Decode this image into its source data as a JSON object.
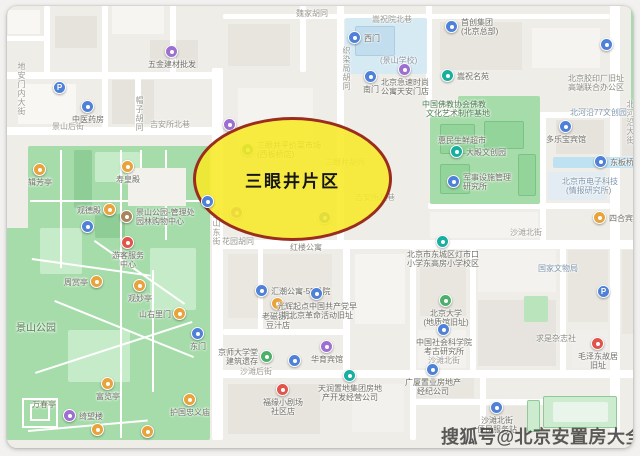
{
  "annotation": {
    "label": "三眼井片区"
  },
  "watermark": {
    "text": "搜狐号@北京安置房大全"
  },
  "colors": {
    "highlight_fill": "rgba(247,233,40,0.88)",
    "highlight_border": "#9b2d1f",
    "watermark": "#403f3d",
    "district": "#efede8",
    "road": "#ffffff",
    "park": "#a6dcaa",
    "water": "#bfe2f2"
  },
  "map": {
    "palette": {
      "blue": "#4f81d8",
      "purple": "#9d6fd0",
      "orange": "#e8a33c",
      "teal": "#17afa0",
      "green": "#4db06a",
      "red": "#e2544a",
      "brown": "#a8855c"
    },
    "blocks": [
      {
        "x": 8,
        "y": 10,
        "w": 32,
        "h": 24,
        "c": "#f8f7f4"
      },
      {
        "x": 55,
        "y": 16,
        "w": 42,
        "h": 32,
        "c": "#e6e3dd"
      },
      {
        "x": 112,
        "y": 6,
        "w": 52,
        "h": 28,
        "c": "#f6f5f2"
      },
      {
        "x": 150,
        "y": 40,
        "w": 48,
        "h": 28,
        "c": "#e6e3dd"
      },
      {
        "x": 18,
        "y": 84,
        "w": 58,
        "h": 40,
        "c": "#f8f7f4"
      },
      {
        "x": 112,
        "y": 80,
        "w": 42,
        "h": 44,
        "c": "#e6e3dd"
      },
      {
        "x": 228,
        "y": 24,
        "w": 62,
        "h": 42,
        "c": "#e8e5df"
      },
      {
        "x": 238,
        "y": 88,
        "w": 75,
        "h": 62,
        "c": "#f4f3ef"
      },
      {
        "x": 440,
        "y": 22,
        "w": 82,
        "h": 48,
        "c": "#e8e5df"
      },
      {
        "x": 532,
        "y": 28,
        "w": 68,
        "h": 40,
        "c": "#f5f4f1"
      },
      {
        "x": 556,
        "y": 120,
        "w": 48,
        "h": 34,
        "c": "#e6e3dd"
      },
      {
        "x": 548,
        "y": 172,
        "w": 58,
        "h": 28,
        "c": "#e3ecf2"
      },
      {
        "x": 430,
        "y": 212,
        "w": 108,
        "h": 26,
        "c": "#f4f3ef"
      },
      {
        "x": 228,
        "y": 254,
        "w": 104,
        "h": 64,
        "c": "#eae7e1"
      },
      {
        "x": 355,
        "y": 254,
        "w": 50,
        "h": 70,
        "c": "#f5f4f1"
      },
      {
        "x": 228,
        "y": 384,
        "w": 92,
        "h": 50,
        "c": "#e7e4de"
      },
      {
        "x": 352,
        "y": 384,
        "w": 52,
        "h": 48,
        "c": "#f2f1ee"
      },
      {
        "x": 420,
        "y": 254,
        "w": 46,
        "h": 62,
        "c": "#e9e6e0"
      },
      {
        "x": 478,
        "y": 250,
        "w": 78,
        "h": 42,
        "c": "#f3f2ef"
      },
      {
        "x": 568,
        "y": 250,
        "w": 40,
        "h": 72,
        "c": "#e9e6e0"
      },
      {
        "x": 478,
        "y": 300,
        "w": 78,
        "h": 66,
        "c": "#e7e4df"
      },
      {
        "x": 418,
        "y": 330,
        "w": 48,
        "h": 38,
        "c": "#f3f2ef"
      },
      {
        "x": 572,
        "y": 330,
        "w": 36,
        "h": 38,
        "c": "#f0efec"
      },
      {
        "x": 416,
        "y": 378,
        "w": 58,
        "h": 20,
        "c": "#e9e6e0"
      },
      {
        "x": 486,
        "y": 406,
        "w": 48,
        "h": 28,
        "c": "#e9e6e0"
      },
      {
        "x": 622,
        "y": 250,
        "w": 18,
        "h": 84,
        "c": "#e9e6e0"
      },
      {
        "x": 622,
        "y": 118,
        "w": 18,
        "h": 38,
        "c": "#e7e4df"
      }
    ],
    "roads": [
      {
        "x": 0,
        "y": 72,
        "w": 213,
        "h": 7
      },
      {
        "x": 0,
        "y": 127,
        "w": 213,
        "h": 8
      },
      {
        "x": 44,
        "y": 6,
        "w": 6,
        "h": 68
      },
      {
        "x": 102,
        "y": 0,
        "w": 6,
        "h": 129
      },
      {
        "x": 135,
        "y": 72,
        "w": 6,
        "h": 57
      },
      {
        "x": 170,
        "y": 0,
        "w": 6,
        "h": 74
      },
      {
        "x": 212,
        "y": 68,
        "w": 11,
        "h": 372
      },
      {
        "x": 212,
        "y": 240,
        "w": 428,
        "h": 9
      },
      {
        "x": 610,
        "y": 0,
        "w": 10,
        "h": 440
      },
      {
        "x": 300,
        "y": 0,
        "w": 6,
        "h": 72
      },
      {
        "x": 337,
        "y": 0,
        "w": 7,
        "h": 242
      },
      {
        "x": 426,
        "y": 0,
        "w": 6,
        "h": 114
      },
      {
        "x": 223,
        "y": 14,
        "w": 387,
        "h": 5
      },
      {
        "x": 428,
        "y": 112,
        "w": 182,
        "h": 6
      },
      {
        "x": 428,
        "y": 203,
        "w": 182,
        "h": 6
      },
      {
        "x": 540,
        "y": 112,
        "w": 6,
        "h": 130
      },
      {
        "x": 223,
        "y": 329,
        "w": 121,
        "h": 6
      },
      {
        "x": 212,
        "y": 370,
        "w": 428,
        "h": 8
      },
      {
        "x": 343,
        "y": 242,
        "w": 7,
        "h": 130
      },
      {
        "x": 410,
        "y": 242,
        "w": 6,
        "h": 198
      },
      {
        "x": 470,
        "y": 242,
        "w": 6,
        "h": 130
      },
      {
        "x": 560,
        "y": 242,
        "w": 6,
        "h": 130
      },
      {
        "x": 410,
        "y": 399,
        "w": 152,
        "h": 6
      },
      {
        "x": 480,
        "y": 372,
        "w": 6,
        "h": 68
      },
      {
        "x": 258,
        "y": 242,
        "w": 5,
        "h": 88
      },
      {
        "x": 0,
        "y": 36,
        "w": 45,
        "h": 5
      }
    ],
    "areas": [
      {
        "x": 28,
        "y": 146,
        "w": 182,
        "h": 294,
        "c": "#a6dcaa"
      },
      {
        "x": 0,
        "y": 228,
        "w": 30,
        "h": 212,
        "c": "#a6dcaa"
      },
      {
        "x": 95,
        "y": 152,
        "w": 45,
        "h": 30,
        "c": "#c6ebc8"
      },
      {
        "x": 40,
        "y": 228,
        "w": 42,
        "h": 46,
        "c": "#c6ebc8"
      },
      {
        "x": 150,
        "y": 248,
        "w": 46,
        "h": 62,
        "c": "#c6ebc8"
      },
      {
        "x": 68,
        "y": 330,
        "w": 62,
        "h": 52,
        "c": "#c6ebc8"
      },
      {
        "x": 74,
        "y": 150,
        "w": 18,
        "h": 58,
        "c": "#8fcd96"
      },
      {
        "x": 95,
        "y": 214,
        "w": 30,
        "h": 24,
        "c": "#8fcd96"
      },
      {
        "x": 430,
        "y": 116,
        "w": 110,
        "h": 88,
        "c": "#a6dcaa"
      },
      {
        "x": 458,
        "y": 96,
        "w": 82,
        "h": 22,
        "c": "#a6dcaa"
      },
      {
        "x": 440,
        "y": 124,
        "w": 35,
        "h": 30,
        "c": "#93d49a",
        "b": "#7cc287"
      },
      {
        "x": 484,
        "y": 121,
        "w": 40,
        "h": 28,
        "c": "#93d49a",
        "b": "#7cc287"
      },
      {
        "x": 440,
        "y": 164,
        "w": 30,
        "h": 30,
        "c": "#93d49a",
        "b": "#7cc287"
      },
      {
        "x": 518,
        "y": 154,
        "w": 18,
        "h": 42,
        "c": "#93d49a",
        "b": "#7cc287"
      },
      {
        "x": 631,
        "y": 0,
        "w": 9,
        "h": 112,
        "c": "#a6dcaa"
      },
      {
        "x": 524,
        "y": 296,
        "w": 24,
        "h": 26,
        "c": "#b9e4bc"
      },
      {
        "x": 527,
        "y": 400,
        "w": 13,
        "h": 32,
        "c": "#cdeccf",
        "b": "#8fc997"
      },
      {
        "x": 543,
        "y": 396,
        "w": 74,
        "h": 32,
        "c": "#cdeccf",
        "b": "#8fc997"
      },
      {
        "x": 553,
        "y": 402,
        "w": 55,
        "h": 20,
        "c": "#e9f5ea"
      },
      {
        "x": 345,
        "y": 18,
        "w": 82,
        "h": 56,
        "c": "#d6eaf4"
      },
      {
        "x": 355,
        "y": 26,
        "w": 40,
        "h": 30,
        "c": "#c2ddee",
        "b": "#aecde0"
      },
      {
        "x": 553,
        "y": 157,
        "w": 87,
        "h": 11,
        "c": "#bfe2f2"
      }
    ],
    "paths": [
      {
        "x": 30,
        "y": 200,
        "w": 172,
        "h": 2
      },
      {
        "x": 120,
        "y": 150,
        "w": 2,
        "h": 288
      },
      {
        "x": 60,
        "y": 150,
        "w": 2,
        "h": 118
      },
      {
        "x": 55,
        "y": 300,
        "w": 150,
        "h": 2,
        "rot": 22
      },
      {
        "x": 35,
        "y": 372,
        "w": 165,
        "h": 2,
        "rot": -18
      },
      {
        "x": 152,
        "y": 270,
        "w": 2,
        "h": 122
      },
      {
        "x": 32,
        "y": 258,
        "w": 120,
        "h": 2,
        "rot": 8
      },
      {
        "x": 165,
        "y": 150,
        "w": 2,
        "h": 90
      },
      {
        "x": 28,
        "y": 430,
        "w": 120,
        "h": 2,
        "rot": -5
      },
      {
        "x": 95,
        "y": 240,
        "w": 110,
        "h": 2,
        "rot": 35
      },
      {
        "x": 140,
        "y": 150,
        "w": 2,
        "h": 20
      },
      {
        "x": 128,
        "y": 168,
        "w": 58,
        "h": 38,
        "c": "#f2f1ec"
      },
      {
        "x": 22,
        "y": 398,
        "w": 36,
        "h": 30,
        "b": "#ffffff"
      },
      {
        "x": 30,
        "y": 404,
        "w": 20,
        "h": 17,
        "b": "#ffffff"
      }
    ],
    "labels": [
      {
        "x": 17,
        "y": 62,
        "t": "地安门内大街",
        "v": 1,
        "c": "#9a9992"
      },
      {
        "x": 52,
        "y": 122,
        "t": "景山后街",
        "c": "#9a9992"
      },
      {
        "x": 150,
        "y": 120,
        "t": "吉安所北巷",
        "c": "#9a9992"
      },
      {
        "x": 135,
        "y": 96,
        "t": "帽子胡同",
        "v": 1,
        "c": "#9a9992"
      },
      {
        "x": 212,
        "y": 210,
        "t": "景山东街",
        "v": 1,
        "c": "#9a9992"
      },
      {
        "x": 372,
        "y": 15,
        "t": "嵩祝院北巷",
        "c": "#9a9992"
      },
      {
        "x": 296,
        "y": 9,
        "t": "魏家胡同",
        "c": "#9a9992"
      },
      {
        "x": 342,
        "y": 46,
        "t": "织染局胡同",
        "v": 1,
        "c": "#9a9992"
      },
      {
        "x": 380,
        "y": 56,
        "t": "(景山学校)",
        "c": "#8d98a3"
      },
      {
        "x": 568,
        "y": 74,
        "t": "北京胶印厂旧址",
        "c": "#8a8a82"
      },
      {
        "x": 568,
        "y": 83,
        "t": "高端联合办公区",
        "c": "#8a8a82"
      },
      {
        "x": 570,
        "y": 108,
        "t": "北河沿77文创园",
        "c": "#7d96ad"
      },
      {
        "x": 626,
        "y": 100,
        "t": "北河沿大街",
        "v": 1,
        "c": "#9a9992"
      },
      {
        "x": 562,
        "y": 177,
        "t": "北京市电子科技",
        "c": "#7d96ad"
      },
      {
        "x": 566,
        "y": 186,
        "t": "(情报研究所)",
        "c": "#7d96ad"
      },
      {
        "x": 538,
        "y": 264,
        "t": "国家文物局",
        "c": "#7d96ad"
      },
      {
        "x": 536,
        "y": 334,
        "t": "求是杂志社",
        "c": "#8a8a82"
      },
      {
        "x": 510,
        "y": 228,
        "t": "沙滩北街",
        "c": "#9a9992"
      },
      {
        "x": 240,
        "y": 367,
        "t": "沙滩后街",
        "c": "#9a9992"
      },
      {
        "x": 428,
        "y": 356,
        "t": "沙滩北街",
        "c": "#9a9992"
      },
      {
        "x": 222,
        "y": 237,
        "t": "花园胡同",
        "c": "#9a9992",
        "u": 1
      },
      {
        "x": 290,
        "y": 243,
        "t": "红楼公寓",
        "c": "#8a8a82"
      },
      {
        "x": 325,
        "y": 158,
        "t": "三眼井胡同",
        "c": "#9a9992",
        "u": 1
      },
      {
        "x": 355,
        "y": 193,
        "t": "吉安所左巷",
        "c": "#9a9992",
        "u": 1
      },
      {
        "x": 438,
        "y": 136,
        "t": "惠民生鲜超市",
        "c": "#6f6f67"
      },
      {
        "x": 422,
        "y": 100,
        "t": "中国佛教协会佛教",
        "c": "#4e7d52"
      },
      {
        "x": 426,
        "y": 109,
        "t": "文化艺术制作基地",
        "c": "#4e7d52"
      },
      {
        "x": 16,
        "y": 324,
        "t": "景山公园",
        "c": "#4e7d4e",
        "s": 10
      },
      {
        "x": 32,
        "y": 400,
        "t": "万春亭",
        "c": "#6f7a5f"
      }
    ],
    "markers": [
      {
        "x": 172,
        "y": 52,
        "c": "purple",
        "l": [
          "五金建材批发"
        ],
        "lp": "b"
      },
      {
        "x": 60,
        "y": 88,
        "c": "blue",
        "g": "P"
      },
      {
        "x": 88,
        "y": 107,
        "c": "blue",
        "l": [
          "中医药房"
        ],
        "lp": "b"
      },
      {
        "x": 355,
        "y": 38,
        "c": "blue",
        "l": [
          "西门"
        ],
        "lp": "r"
      },
      {
        "x": 452,
        "y": 27,
        "c": "blue",
        "l": [
          "首创集团",
          "(北京总部)"
        ],
        "lp": "r"
      },
      {
        "x": 405,
        "y": 70,
        "c": "purple",
        "l": [
          "北京急速时尚",
          "公寓天安门店"
        ],
        "lp": "b"
      },
      {
        "x": 371,
        "y": 77,
        "c": "blue",
        "l": [
          "南门"
        ],
        "lp": "b"
      },
      {
        "x": 448,
        "y": 76,
        "c": "teal",
        "l": [
          "嵩祝名苑"
        ],
        "lp": "r"
      },
      {
        "x": 607,
        "y": 45,
        "c": "blue"
      },
      {
        "x": 601,
        "y": 162,
        "c": "blue",
        "l": [
          "东板桥"
        ],
        "lp": "r"
      },
      {
        "x": 600,
        "y": 218,
        "c": "orange",
        "l": [
          "四合宾馆"
        ],
        "lp": "r"
      },
      {
        "x": 566,
        "y": 127,
        "c": "blue",
        "l": [
          "多乐宝宾馆"
        ],
        "lp": "b"
      },
      {
        "x": 457,
        "y": 152,
        "c": "teal",
        "l": [
          "大殿文创园"
        ],
        "lp": "r"
      },
      {
        "x": 454,
        "y": 182,
        "c": "blue",
        "l": [
          "军事设施管理",
          "研究所"
        ],
        "lp": "r"
      },
      {
        "x": 443,
        "y": 242,
        "c": "teal",
        "l": [
          "北京市东城区灯市口",
          "小学东高房小学校区"
        ],
        "lp": "b"
      },
      {
        "x": 262,
        "y": 291,
        "c": "blue",
        "l": [
          "汇潮公寓-55号院"
        ],
        "lp": "r"
      },
      {
        "x": 278,
        "y": 304,
        "c": "orange",
        "l": [
          "老磁器口",
          "豆汁店"
        ],
        "lp": "b"
      },
      {
        "x": 317,
        "y": 294,
        "c": "blue",
        "l": [
          "光辉起点中国共产党早",
          "期北京革命活动旧址"
        ],
        "lp": "b"
      },
      {
        "x": 208,
        "y": 202,
        "c": "blue"
      },
      {
        "x": 230,
        "y": 125,
        "c": "purple",
        "u": 1
      },
      {
        "x": 237,
        "y": 213,
        "c": "purple",
        "u": 1
      },
      {
        "x": 325,
        "y": 218,
        "c": "blue",
        "u": 1
      },
      {
        "x": 248,
        "y": 150,
        "c": "green",
        "l": [
          "三眼井平价菜市场",
          "(西板桥店)"
        ],
        "lp": "r",
        "u": 1
      },
      {
        "x": 128,
        "y": 167,
        "c": "orange",
        "l": [
          "寿皇殿"
        ],
        "lp": "b"
      },
      {
        "x": 40,
        "y": 170,
        "c": "orange",
        "l": [
          "辑芳亭"
        ],
        "lp": "b"
      },
      {
        "x": 110,
        "y": 210,
        "c": "orange",
        "l": [
          "观德殿"
        ],
        "lp": "l"
      },
      {
        "x": 127,
        "y": 217,
        "c": "brown",
        "l": [
          "景山公园-管理处",
          "园林购物中心"
        ],
        "lp": "r"
      },
      {
        "x": 88,
        "y": 227,
        "c": "blue"
      },
      {
        "x": 128,
        "y": 243,
        "c": "red",
        "l": [
          "游客服务",
          "中心"
        ],
        "lp": "b"
      },
      {
        "x": 97,
        "y": 282,
        "c": "orange",
        "l": [
          "周赏亭"
        ],
        "lp": "l"
      },
      {
        "x": 140,
        "y": 286,
        "c": "orange",
        "l": [
          "观妙亭"
        ],
        "lp": "b"
      },
      {
        "x": 180,
        "y": 314,
        "c": "orange",
        "l": [
          "山右里门"
        ],
        "lp": "l"
      },
      {
        "x": 198,
        "y": 334,
        "c": "blue",
        "l": [
          "东门"
        ],
        "lp": "b"
      },
      {
        "x": 108,
        "y": 384,
        "c": "orange",
        "l": [
          "富览亭"
        ],
        "lp": "b"
      },
      {
        "x": 70,
        "y": 416,
        "c": "purple",
        "l": [
          "绮望楼"
        ],
        "lp": "r"
      },
      {
        "x": 98,
        "y": 430,
        "c": "orange"
      },
      {
        "x": 148,
        "y": 432,
        "c": "orange"
      },
      {
        "x": 190,
        "y": 400,
        "c": "orange",
        "l": [
          "护国忠义庙"
        ],
        "lp": "b"
      },
      {
        "x": 267,
        "y": 357,
        "c": "green",
        "l": [
          "京师大学堂",
          "建筑遗存"
        ],
        "lp": "l"
      },
      {
        "x": 295,
        "y": 361,
        "c": "blue"
      },
      {
        "x": 327,
        "y": 347,
        "c": "purple",
        "l": [
          "华育宾馆"
        ],
        "lp": "b"
      },
      {
        "x": 283,
        "y": 390,
        "c": "red",
        "l": [
          "福缘小剧场",
          "社区店"
        ],
        "lp": "b"
      },
      {
        "x": 350,
        "y": 376,
        "c": "teal",
        "l": [
          "天润置地集团房地",
          "产开发经营公司"
        ],
        "lp": "b"
      },
      {
        "x": 433,
        "y": 370,
        "c": "blue",
        "l": [
          "广厦置业房地产",
          "经纪公司"
        ],
        "lp": "b"
      },
      {
        "x": 497,
        "y": 408,
        "c": "blue",
        "l": [
          "沙滩北街",
          "便民服务站"
        ],
        "lp": "b"
      },
      {
        "x": 598,
        "y": 344,
        "c": "red",
        "l": [
          "毛泽东故居",
          "旧址"
        ],
        "lp": "b"
      },
      {
        "x": 604,
        "y": 292,
        "c": "blue",
        "g": "P"
      },
      {
        "x": 446,
        "y": 301,
        "c": "green",
        "l": [
          "北京大学",
          "(地质馆旧址)"
        ],
        "lp": "b"
      },
      {
        "x": 444,
        "y": 330,
        "c": "blue",
        "l": [
          "中国社会科学院",
          "考古研究所"
        ],
        "lp": "b"
      }
    ]
  }
}
